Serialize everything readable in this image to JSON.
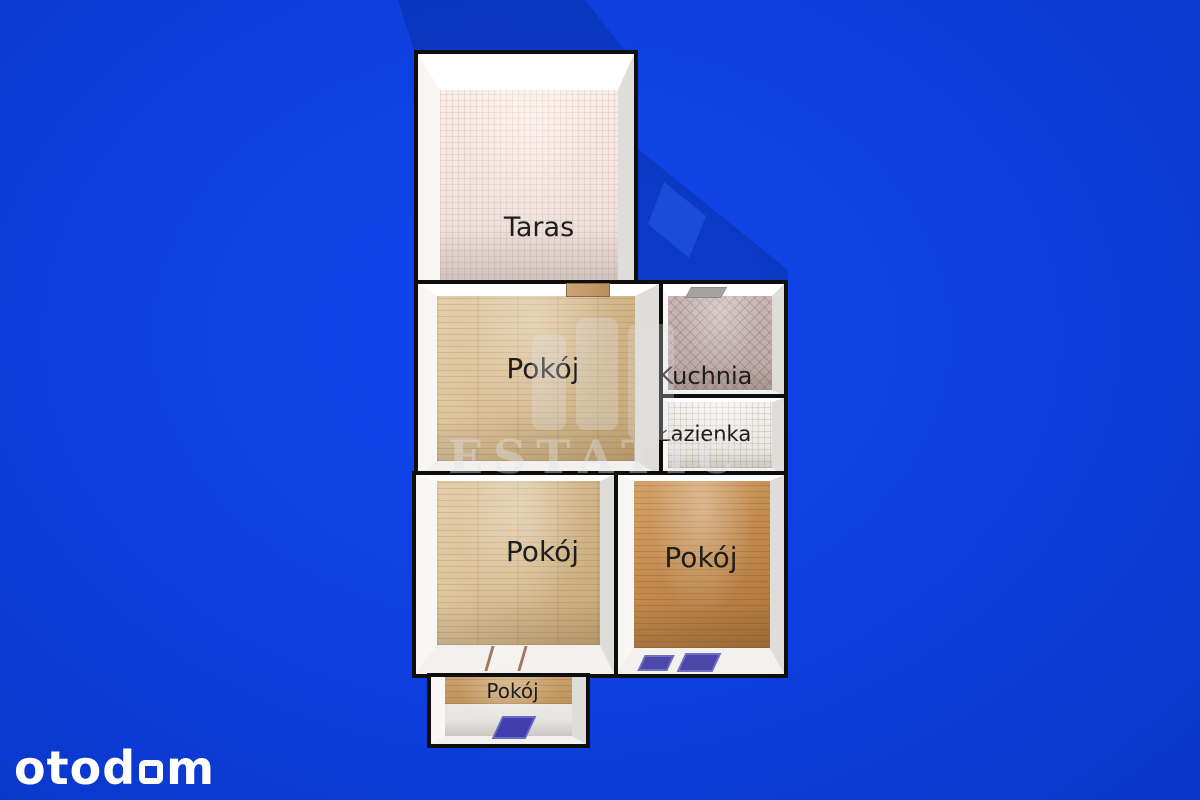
{
  "image": {
    "kind": "3d-floor-plan-render",
    "width": 1200,
    "height": 800
  },
  "rooms": [
    {
      "id": "taras",
      "label": "Taras",
      "floor": "pink-tile"
    },
    {
      "id": "pokoj-main",
      "label": "Pokój",
      "floor": "light-wood"
    },
    {
      "id": "kuchnia",
      "label": "Kuchnia",
      "floor": "mauve-diagonal-tile"
    },
    {
      "id": "lazienka",
      "label": "Łazienka",
      "floor": "white-tile"
    },
    {
      "id": "pokoj-lower-left",
      "label": "Pokój",
      "floor": "light-wood"
    },
    {
      "id": "pokoj-lower-right",
      "label": "Pokój",
      "floor": "orange-wood"
    },
    {
      "id": "pokoj-small",
      "label": "Pokój",
      "floor": "wood-and-white"
    }
  ],
  "features": {
    "door_between_taras_and_pokoj": "wood-threshold",
    "kuchnia_ceiling_vent": "gray-vent",
    "pokoj_lower_left_door": "white-threshold-brown-jambs",
    "blue_mats_lower_right_room": 2,
    "blue_mat_small_room": 1
  },
  "watermark": {
    "text": "ESTATIC",
    "logo": "three-bars"
  },
  "brand": {
    "name": "otodom",
    "wordmark_left": "otod",
    "wordmark_right": "m",
    "square_glyph": "outlined-rounded-square"
  },
  "palette": {
    "background_blue": "#0d3fde",
    "shadow_blue": "#06237f",
    "outline_black": "#0e0e0e",
    "wall_white": "#ffffff",
    "tile_pink": "#f2e4df",
    "wood_light": "#d5ba8e",
    "tile_mauve": "#c0adac",
    "tile_white": "#ece9e5",
    "wood_orange": "#c08a4e",
    "mat_blue": "#4c48aa",
    "label_text": "#1e1e1e",
    "logo_white": "#ffffff",
    "watermark_gray": "#e4e4ea"
  }
}
